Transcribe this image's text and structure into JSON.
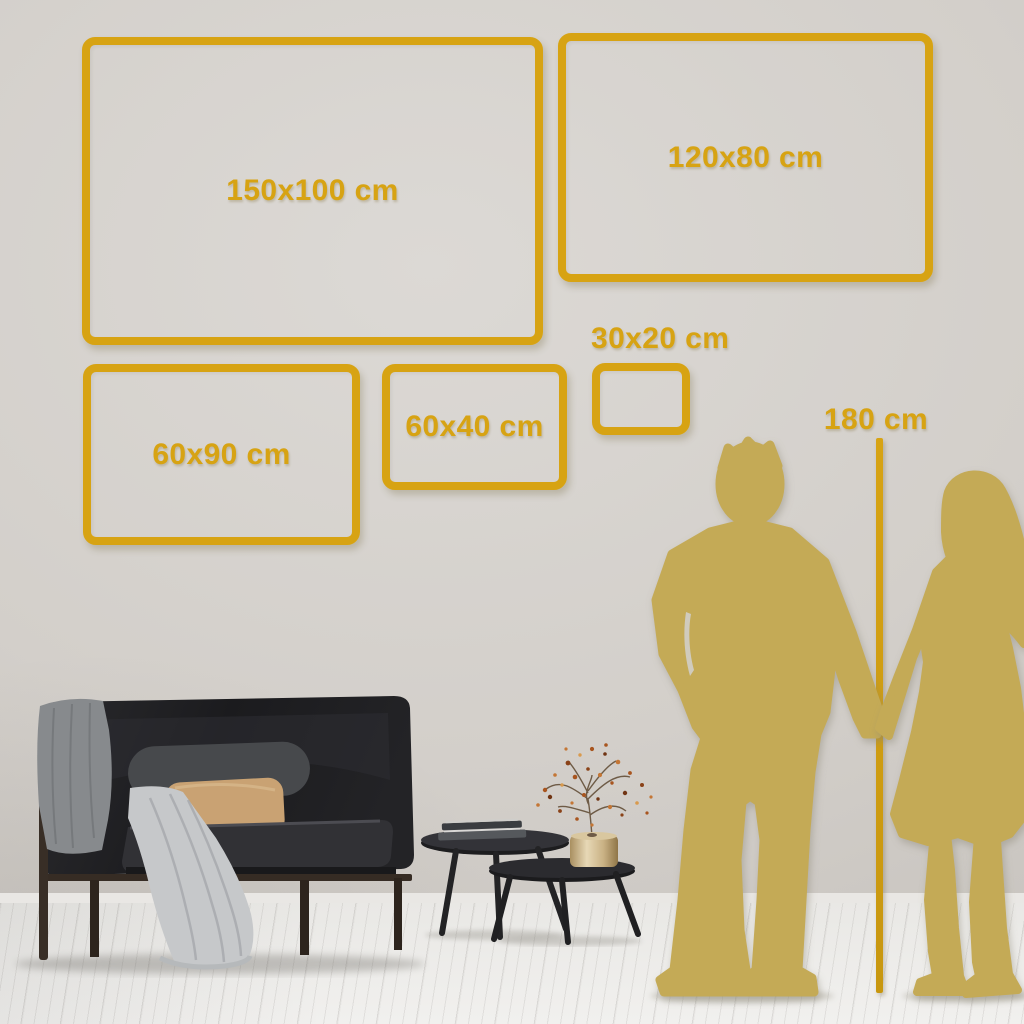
{
  "size_guide": {
    "frames": [
      {
        "label": "150x100 cm"
      },
      {
        "label": "120x80 cm"
      },
      {
        "label": "60x90 cm"
      },
      {
        "label": "60x40 cm"
      },
      {
        "label": "30x20 cm"
      }
    ],
    "height_marker": {
      "label": "180 cm"
    },
    "colors": {
      "accent_gold": "#D7A313",
      "silhouette_gold": "#C4AA57"
    }
  }
}
